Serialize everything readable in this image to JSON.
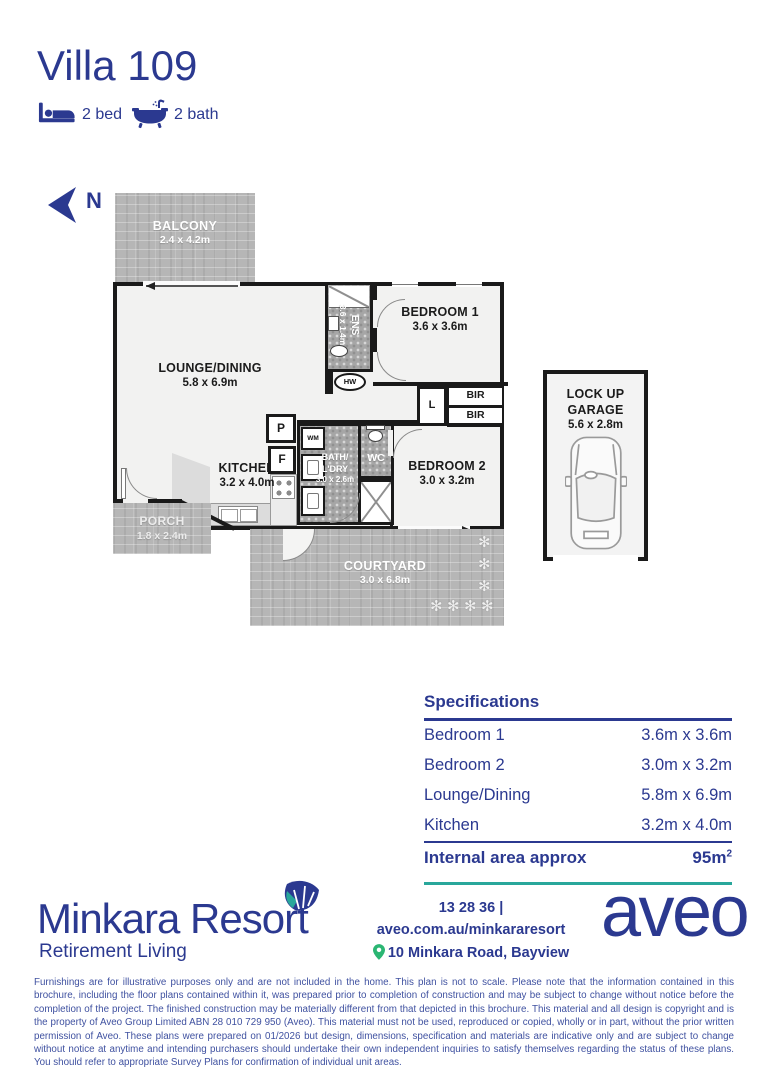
{
  "page": {
    "title": "Villa 109"
  },
  "header": {
    "bed_label": "2 bed",
    "bath_label": "2 bath"
  },
  "compass": {
    "label": "N"
  },
  "plan": {
    "balcony_name": "BALCONY",
    "balcony_dims": "2.4 x 4.2m",
    "lounge_name": "LOUNGE/DINING",
    "lounge_dims": "5.8 x 6.9m",
    "ens_name": "ENS",
    "ens_dims": "3.6 x 1.4m",
    "bed1_name": "BEDROOM 1",
    "bed1_dims": "3.6 x 3.6m",
    "bed2_name": "BEDROOM 2",
    "bed2_dims": "3.0 x 3.2m",
    "kitchen_name": "KITCHEN",
    "kitchen_dims": "3.2 x 4.0m",
    "bath_name1": "BATH/",
    "bath_name2": "L'DRY",
    "bath_dims": "3.0 x 2.6m",
    "wc_label": "WC",
    "hw_label": "HW",
    "linen_label": "L",
    "bir_label": "BIR",
    "pantry_label": "P",
    "fridge_label": "F",
    "wm_label": "WM",
    "porch_name": "PORCH",
    "porch_dims": "1.8 x 2.4m",
    "courtyard_name": "COURTYARD",
    "courtyard_dims": "3.0 x 6.8m",
    "garage_name1": "LOCK UP",
    "garage_name2": "GARAGE",
    "garage_dims": "5.6 x 2.8m"
  },
  "specs": {
    "title": "Specifications",
    "rows": [
      {
        "label": "Bedroom 1",
        "value": "3.6m x 3.6m"
      },
      {
        "label": "Bedroom 2",
        "value": "3.0m x 3.2m"
      },
      {
        "label": "Lounge/Dining",
        "value": "5.8m x 6.9m"
      },
      {
        "label": "Kitchen",
        "value": "3.2m x 4.0m"
      }
    ],
    "total_label": "Internal area approx",
    "total_value": "95m",
    "total_sup": "2"
  },
  "footer": {
    "resort_name": "Minkara Resort",
    "resort_tagline": "Retirement Living",
    "phone": "13 28 36",
    "separator": "|",
    "website": "aveo.com.au/minkararesort",
    "address": "10 Minkara Road, Bayview",
    "brand": "aveo"
  },
  "disclaimer": "Furnishings are for illustrative purposes only and are not included in the home. This plan is not to scale. Please note that the information contained in this brochure, including the floor plans contained within it, was prepared prior to completion of construction and may be subject to change without notice before the completion of the project. The finished construction may be materially different from that depicted in this brochure. This material and all design is copyright and is the property of Aveo Group Limited ABN 28 010 729 950 (Aveo). This material must not be used, reproduced or copied, wholly or in part, without the prior written permission of Aveo. These plans were prepared on 01/2026 but design, dimensions, specification and materials are indicative only and are subject to change without notice at anytime and intending purchasers should undertake their own independent inquiries to satisfy themselves regarding the status of these plans. You should refer to appropriate Survey Plans for confirmation of individual unit areas.",
  "colors": {
    "navy": "#2b3990",
    "teal": "#29a79b",
    "pin_green": "#2bb673"
  }
}
